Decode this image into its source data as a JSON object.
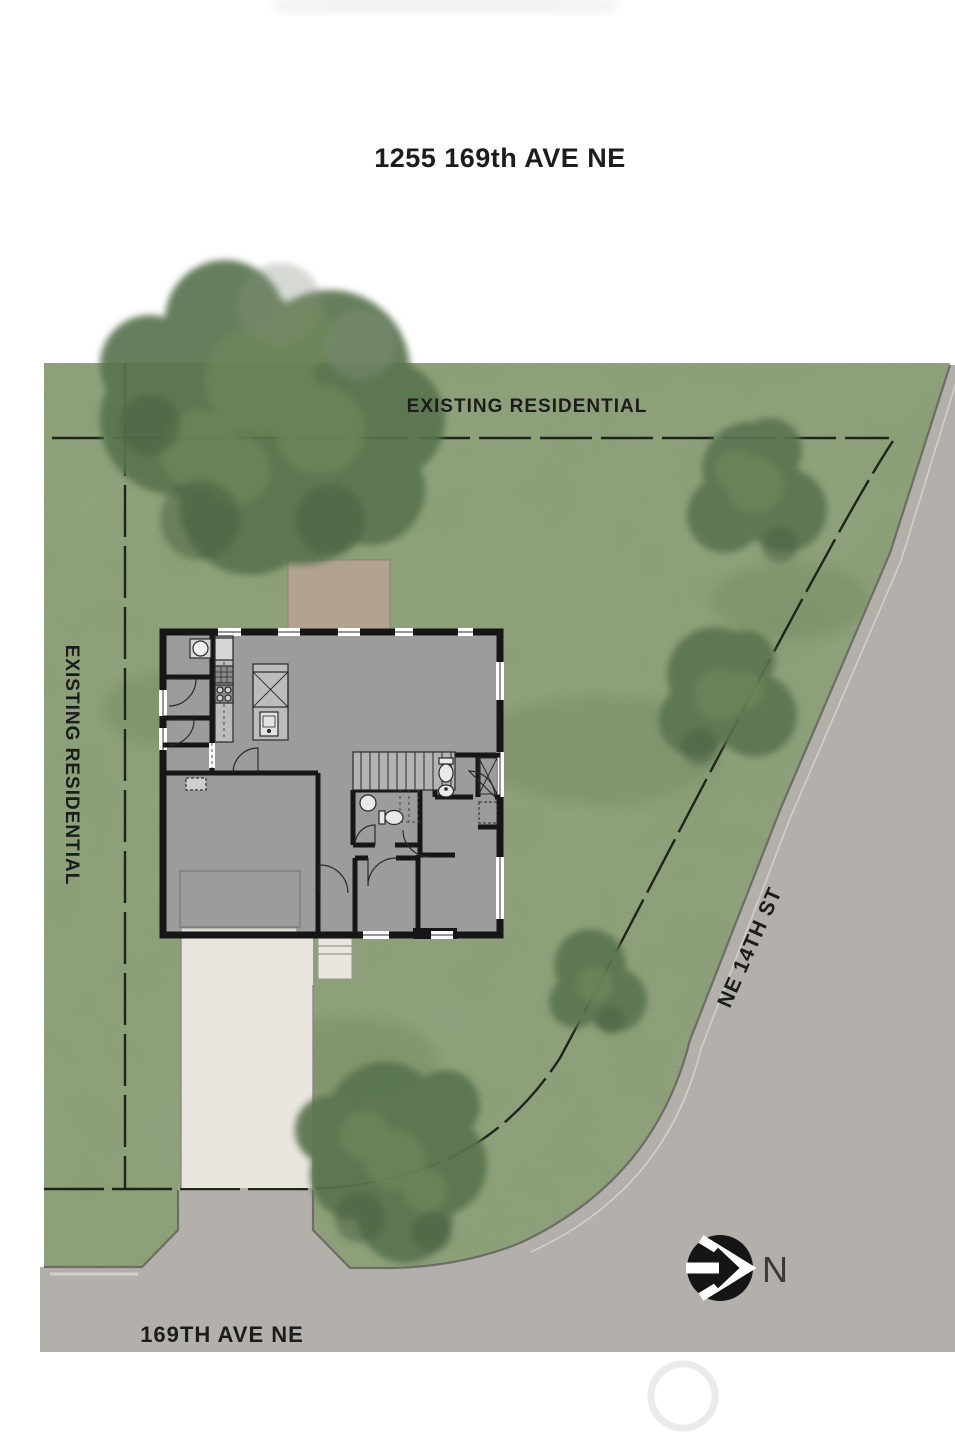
{
  "title": "1255 169th AVE NE",
  "labels": {
    "neighbor_north": "EXISTING RESIDENTIAL",
    "neighbor_west": "EXISTING RESIDENTIAL",
    "street_east": "NE 14TH ST",
    "street_south": "169TH AVE NE",
    "north_indicator": "N"
  },
  "colors": {
    "grass": "#7d9168",
    "grass-light": "#8ea37a",
    "grass-dark": "#6b8159",
    "tree": "#5a7550",
    "tree-light": "#71895c",
    "tree-dark": "#465e3e",
    "road": "#b3b0ab",
    "curb": "#6e6c66",
    "house": "#9c9c9c",
    "counter": "#bcbcbc",
    "wall": "#161616",
    "driveway": "#e9e6df",
    "patio": "#b2a391",
    "label-text": "#1c1c1c"
  }
}
